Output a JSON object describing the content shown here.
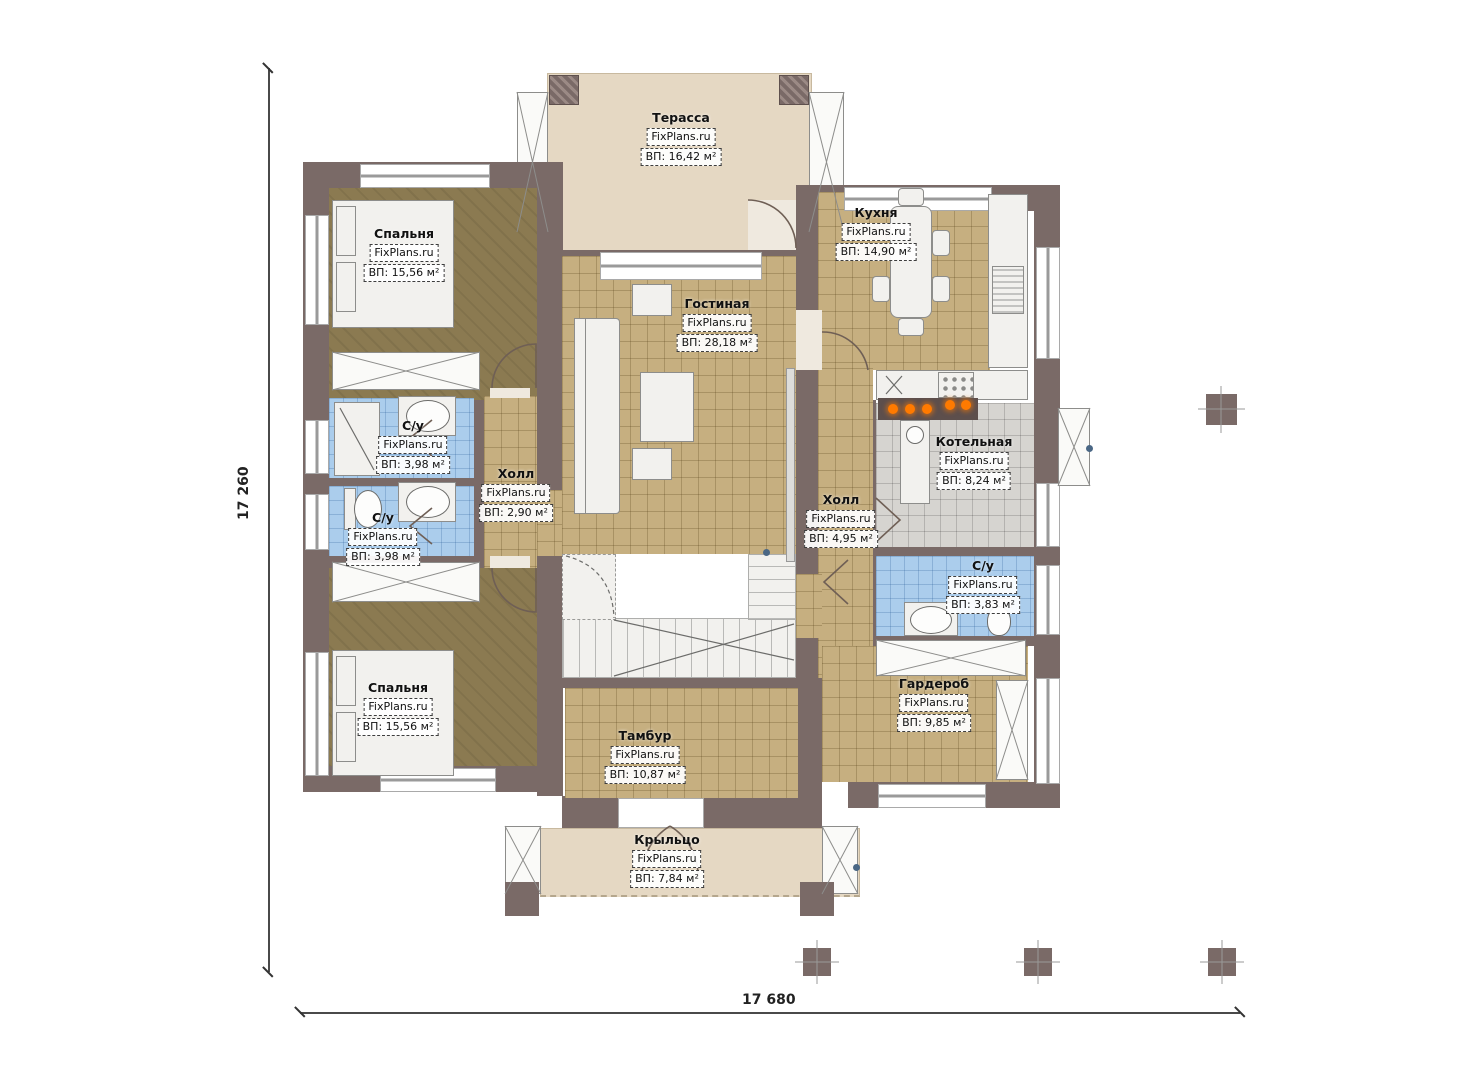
{
  "brand": "FixPlans.ru",
  "plan_title": "План 1-го этажа",
  "dimensions": {
    "left_total": "17 260",
    "bottom_total": "17 680"
  },
  "rooms": [
    {
      "name": "Терасса",
      "brand": "FixPlans.ru",
      "area": "ВП: 16,42 м²"
    },
    {
      "name": "Спальня",
      "brand": "FixPlans.ru",
      "area": "ВП: 15,56 м²"
    },
    {
      "name": "Гостиная",
      "brand": "FixPlans.ru",
      "area": "ВП: 28,18 м²"
    },
    {
      "name": "Кухня",
      "brand": "FixPlans.ru",
      "area": "ВП: 14,90 м²"
    },
    {
      "name": "С/у",
      "brand": "FixPlans.ru",
      "area": "ВП: 3,98 м²"
    },
    {
      "name": "Холл",
      "brand": "FixPlans.ru",
      "area": "ВП: 2,90 м²"
    },
    {
      "name": "С/у",
      "brand": "FixPlans.ru",
      "area": "ВП: 3,98 м²"
    },
    {
      "name": "Холл",
      "brand": "FixPlans.ru",
      "area": "ВП: 4,95 м²"
    },
    {
      "name": "Котельная",
      "brand": "FixPlans.ru",
      "area": "ВП: 8,24 м²"
    },
    {
      "name": "С/у",
      "brand": "FixPlans.ru",
      "area": "ВП: 3,83 м²"
    },
    {
      "name": "Гардероб",
      "brand": "FixPlans.ru",
      "area": "ВП: 9,85 м²"
    },
    {
      "name": "Спальня",
      "brand": "FixPlans.ru",
      "area": "ВП: 15,56 м²"
    },
    {
      "name": "Тамбур",
      "brand": "FixPlans.ru",
      "area": "ВП: 10,87 м²"
    },
    {
      "name": "Крыльцо",
      "brand": "FixPlans.ru",
      "area": "ВП: 7,84 м²"
    }
  ],
  "colors": {
    "wall": "#7a6a67",
    "floor_tile_tan": "#c6af80",
    "floor_bedroom": "#8b7a51",
    "floor_bath_blue": "#abcdec",
    "floor_boiler_gray": "#d6d4d0",
    "floor_terrace_beige": "#e5d8c3",
    "burner_orange": "#ff7a00"
  }
}
